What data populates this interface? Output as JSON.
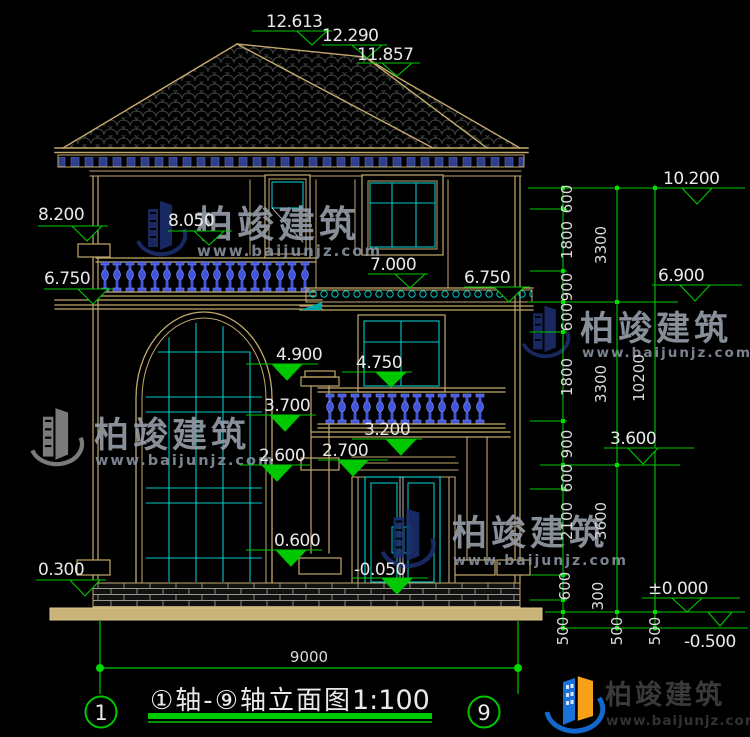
{
  "watermark": {
    "brand": "柏竣建筑",
    "site": "www.baijunjz.com"
  },
  "footer": {
    "brand": "柏竣建筑",
    "site": "www.baijunjz.com"
  },
  "drawing": {
    "marks": {
      "peak": "12.613",
      "ridge": "12.290",
      "hip": "11.857",
      "l8200": "8.200",
      "l8050": "8.050",
      "l6750": "6.750",
      "m7000": "7.000",
      "r6750": "6.750",
      "m4900": "4.900",
      "m4750": "4.750",
      "m3700": "3.700",
      "m3200": "3.200",
      "m2600": "2.600",
      "m2700": "2.700",
      "m0600": "0.600",
      "m0300": "0.300",
      "mneg005": "-0.050",
      "r10200": "10.200",
      "r6900": "6.900",
      "r3600": "3.600",
      "rzero": "±0.000",
      "rneg05": "-0.500"
    },
    "chains": {
      "col1": [
        "600",
        "1800",
        "900",
        "600",
        "1800",
        "900",
        "600",
        "2100",
        "600",
        "300",
        "500"
      ],
      "col2": [
        "3300",
        "3300",
        "3600",
        "500"
      ],
      "col3": [
        "10200",
        "500"
      ],
      "width": "9000"
    },
    "axes": {
      "start": "1",
      "end": "9"
    },
    "caption": {
      "title": "①轴-⑨轴立面图",
      "scale": "1:100"
    }
  }
}
